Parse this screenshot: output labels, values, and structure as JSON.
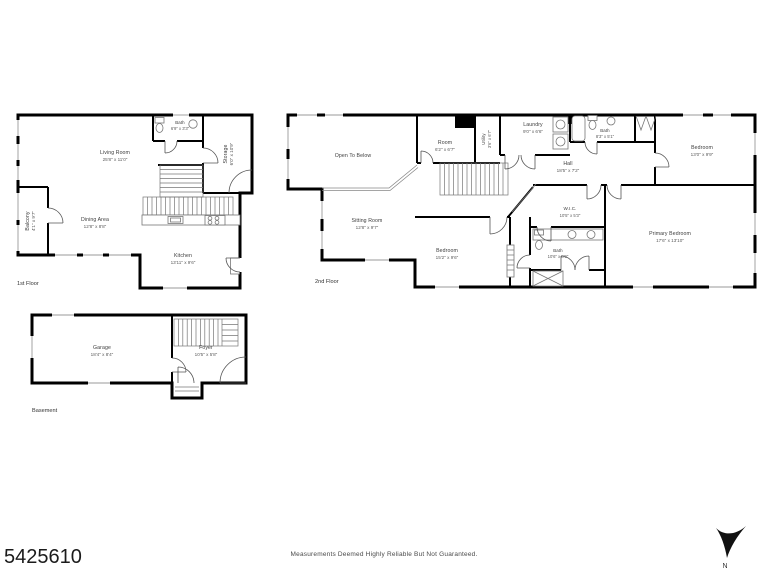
{
  "page": {
    "listing_id": "5425610",
    "disclaimer": "Measurements Deemed Highly Reliable But Not Guaranteed.",
    "compass_label": "N"
  },
  "floors": {
    "first": {
      "label": "1st Floor",
      "rooms": {
        "living": {
          "name": "Living Room",
          "dim": "25'8\" x 11'0\""
        },
        "bath": {
          "name": "Bath",
          "dim": "6'9\" x 3'3\""
        },
        "storage": {
          "name": "Storage",
          "dim": "6'0\" x 10'9\""
        },
        "balcony": {
          "name": "Balcony",
          "dim": "4'1\" x 9'7\""
        },
        "dining": {
          "name": "Dining Area",
          "dim": "12'8\" x 8'8\""
        },
        "kitchen": {
          "name": "Kitchen",
          "dim": "13'11\" x 9'6\""
        }
      }
    },
    "second": {
      "label": "2nd Floor",
      "rooms": {
        "open_to_below": {
          "name": "Open To Below",
          "dim": ""
        },
        "room": {
          "name": "Room",
          "dim": "6'2\" x 6'7\""
        },
        "utility": {
          "name": "Utility",
          "dim": "3'6\" x 6'7\""
        },
        "laundry": {
          "name": "Laundry",
          "dim": "9'0\" x 6'6\""
        },
        "bath_upper": {
          "name": "Bath",
          "dim": "8'3\" x 5'1\""
        },
        "bedroom_right": {
          "name": "Bedroom",
          "dim": "13'0\" x 9'9\""
        },
        "hall": {
          "name": "Hall",
          "dim": "18'5\" x 7'2\""
        },
        "sitting": {
          "name": "Sitting Room",
          "dim": "12'8\" x 9'7\""
        },
        "bedroom_left": {
          "name": "Bedroom",
          "dim": "15'2\" x 9'6\""
        },
        "wic": {
          "name": "W.I.C.",
          "dim": "10'5\" x 5'3\""
        },
        "bath_primary": {
          "name": "Bath",
          "dim": "10'6\" x 8'2\""
        },
        "primary": {
          "name": "Primary Bedroom",
          "dim": "17'6\" x 13'10\""
        }
      }
    },
    "basement": {
      "label": "Basement",
      "rooms": {
        "garage": {
          "name": "Garage",
          "dim": "18'4\" x 8'4\""
        },
        "foyer": {
          "name": "Foyer",
          "dim": "10'5\" x 5'8\""
        }
      }
    }
  }
}
